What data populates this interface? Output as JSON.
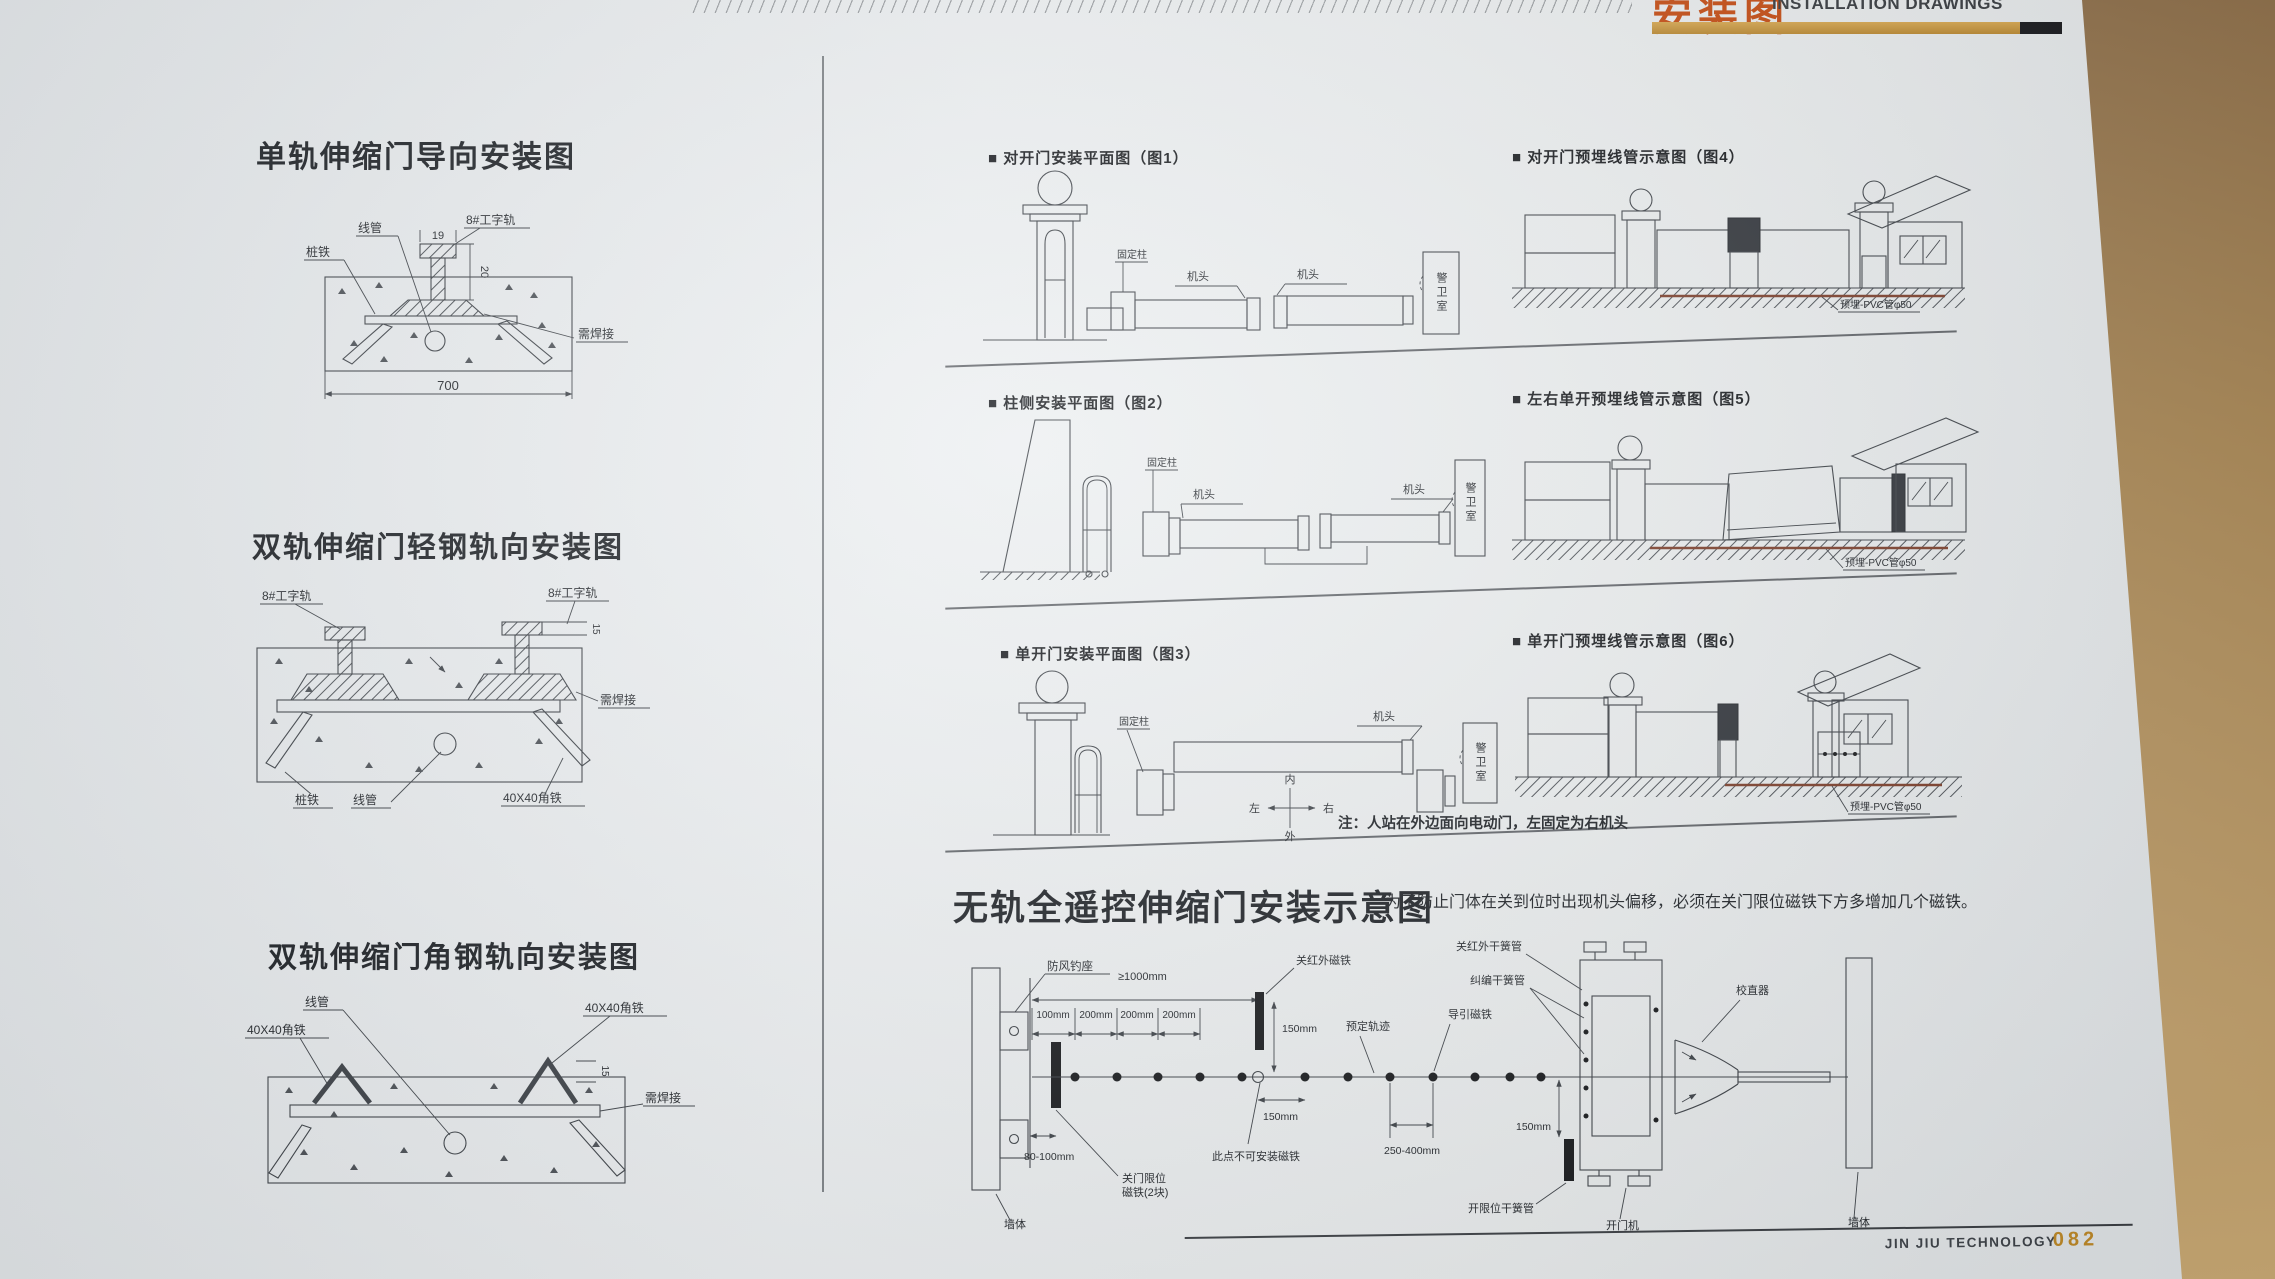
{
  "page_header": {
    "title_cn": "安装图",
    "title_en": "INSTALLATION DRAWINGS"
  },
  "page_footer": {
    "brand": "JIN JIU TECHNOLOGY",
    "page_no": "082"
  },
  "colors": {
    "accent_gold": "#c49a4a",
    "header_red": "#c4490f",
    "paper": "#e9eced",
    "desk_brown": "#a88653",
    "pvc_line": "#7a3c28"
  },
  "d1": {
    "title": "单轨伸缩门导向安装图",
    "lbl_xianguan": "线管",
    "lbl_zhuangtie": "桩铁",
    "lbl_rail": "8#工字轨",
    "lbl_weld": "需焊接",
    "dim_19": "19",
    "dim_20": "20",
    "dim_700": "700"
  },
  "d2": {
    "title": "双轨伸缩门轻钢轨向安装图",
    "lbl_rail_l": "8#工字轨",
    "lbl_rail_r": "8#工字轨",
    "lbl_weld": "需焊接",
    "lbl_zhuangtie": "桩铁",
    "lbl_xianguan": "线管",
    "lbl_angle": "40X40角铁",
    "dim_15": "15"
  },
  "d3": {
    "title": "双轨伸缩门角钢轨向安装图",
    "lbl_xianguan": "线管",
    "lbl_angle_l": "40X40角铁",
    "lbl_angle_r": "40X40角铁",
    "lbl_weld": "需焊接",
    "dim_15": "15"
  },
  "f1": {
    "title": "■ 对开门安装平面图（图1）",
    "lbl_gudingzhu": "固定柱",
    "lbl_jitou_l": "机头",
    "lbl_jitou_r": "机头",
    "lbl_guard": "警卫室"
  },
  "f4": {
    "title": "■ 对开门预埋线管示意图（图4）",
    "lbl_pvc": "预埋-PVC管φ50"
  },
  "f2": {
    "title": "■ 柱侧安装平面图（图2）",
    "lbl_gudingzhu": "固定柱",
    "lbl_jitou_l": "机头",
    "lbl_jitou_r": "机头",
    "lbl_guard": "警卫室"
  },
  "f5": {
    "title": "■ 左右单开预埋线管示意图（图5）",
    "lbl_pvc": "预埋-PVC管φ50"
  },
  "f3": {
    "title": "■ 单开门安装平面图（图3）",
    "lbl_gudingzhu": "固定柱",
    "lbl_jitou": "机头",
    "lbl_guard": "警卫室",
    "compass_n": "内",
    "compass_s": "外",
    "compass_w": "左",
    "compass_e": "右",
    "note": "注：人站在外边面向电动门，左固定为右机头"
  },
  "f6": {
    "title": "■ 单开门预埋线管示意图（图6）",
    "lbl_pvc": "预埋-PVC管φ50"
  },
  "b": {
    "title": "无轨全遥控伸缩门安装示意图",
    "note": "为了防止门体在关到位时出现机头偏移，必须在关门限位磁铁下方多增加几个磁铁。",
    "lbl_fangfeng": "防风钓座",
    "lbl_wall_l": "墙体",
    "lbl_wall_r": "墙体",
    "lbl_guan_citie": "关红外磁铁",
    "lbl_guan_reed": "关红外干簧管",
    "lbl_jiubian_reed": "纠编干簧管",
    "lbl_yuding": "预定轨迹",
    "lbl_daoyin": "导引磁铁",
    "lbl_nomag": "此点不可安装磁铁",
    "lbl_xianwei_1": "关门限位",
    "lbl_xianwei_2": "磁铁(2块)",
    "lbl_kai_reed": "开限位干簧管",
    "lbl_kaimenji": "开门机",
    "lbl_jiaozhi": "校直器",
    "dim_1000": "≥1000mm",
    "dim_100": "100mm",
    "dim_200a": "200mm",
    "dim_200b": "200mm",
    "dim_200c": "200mm",
    "dim_80": "80-100mm",
    "dim_150a": "150mm",
    "dim_150b": "150mm",
    "dim_150c": "150mm",
    "dim_250": "250-400mm"
  }
}
